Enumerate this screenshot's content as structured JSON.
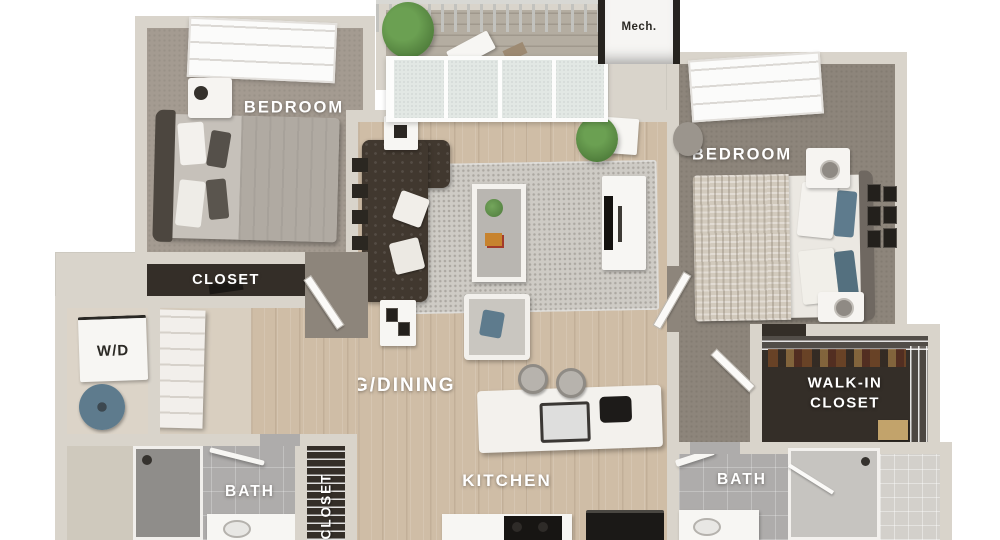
{
  "title": "2 Bedroom 2 Bath Apartment 3D Floor Plan",
  "rooms": {
    "bedroom_left": {
      "label": "BEDROOM"
    },
    "bedroom_right": {
      "label": "BEDROOM"
    },
    "closet_left": {
      "label": "CLOSET"
    },
    "hall_closet": {
      "label": "CLOSET"
    },
    "walk_in_closet": {
      "label_line1": "WALK-IN",
      "label_line2": "CLOSET"
    },
    "living_dining": {
      "label": "LIVING/DINING"
    },
    "kitchen": {
      "label": "KITCHEN"
    },
    "bath_left": {
      "label": "BATH"
    },
    "bath_right": {
      "label": "BATH"
    },
    "laundry": {
      "label": "W/D"
    },
    "mechanical": {
      "label": "Mech."
    }
  },
  "colors": {
    "wall": "#d9d4cb",
    "carpet": "#a49b91",
    "carpet_dark": "#8d857b",
    "wood": "#cfbda6",
    "deck": "#b4ada1",
    "tile": "#aeacab",
    "closet_interior": "#342e28",
    "rug": "#cecbc5",
    "sofa": "#41382f",
    "accent_blue": "#5e7b8d",
    "plant_green": "#5a8a44",
    "label_text": "#ffffff",
    "dark_label_text": "#2b2924"
  }
}
